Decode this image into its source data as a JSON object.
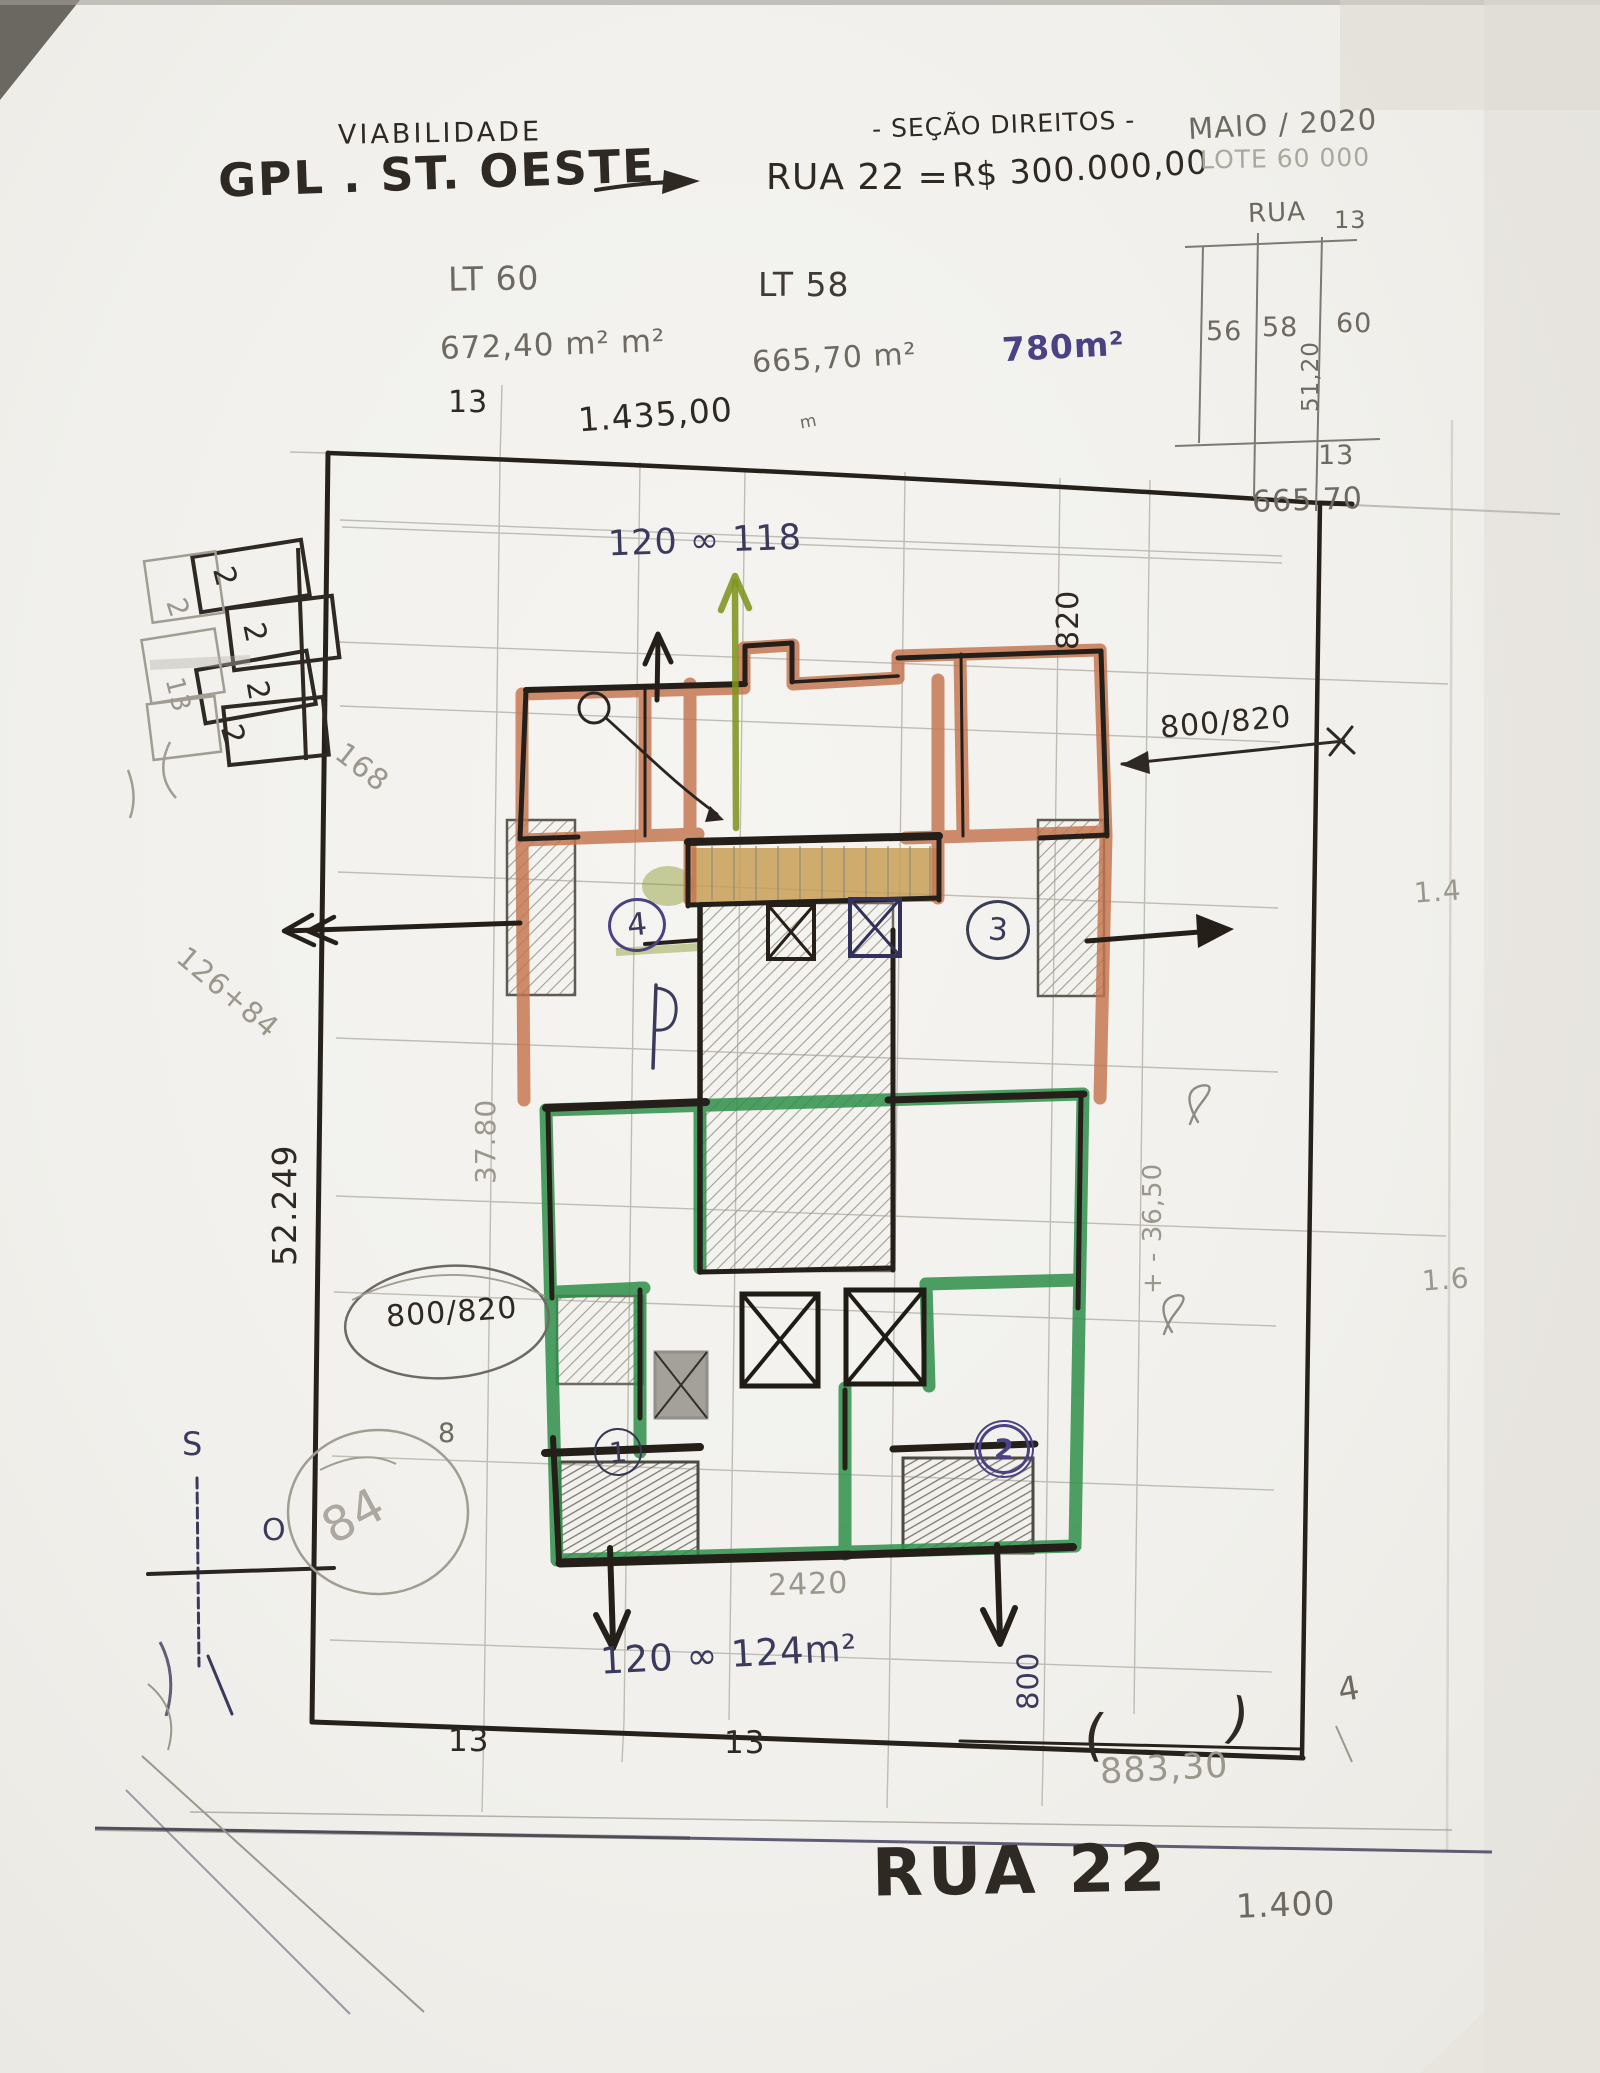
{
  "header": {
    "subtitle": "VIABILIDADE",
    "title": "GPL . ST. OESTE",
    "section_note": "- SEÇÃO DIREITOS -",
    "street": "RUA 22 =",
    "price": "R$ 300.000,00",
    "date": "MAIO / 2020",
    "lot_note": "LOTE 60 000"
  },
  "lots": {
    "lt60": {
      "label": "LT 60",
      "area": "672,40 m² m²"
    },
    "lt58": {
      "label": "LT 58",
      "area": "665,70 m²"
    },
    "proposed_area": "780m²"
  },
  "minimap": {
    "street": "RUA",
    "street_number": "13",
    "lot_56": "56",
    "lot_58": "58",
    "lot_60": "60",
    "width": "51,20",
    "front": "13",
    "depth": "665 70"
  },
  "dimensions": {
    "front_13": "13",
    "top_length": "1.435,00",
    "top_length_unit": "m",
    "units_top": "120 ∞ 118",
    "depth_820": "820",
    "right_800_820": "800/820",
    "left_52_249": "52.249",
    "note_126_84": "126+84",
    "note_168": "168",
    "width_37_80": "37.80",
    "level_36_50": "+ - 36,50",
    "circled_800_820": "800/820",
    "note_84": "84",
    "note_8": "8",
    "bottom_2420": "2420",
    "units_bottom": "120 ∞ 124m²",
    "bottom_800": "800",
    "bottom_13_left": "13",
    "bottom_13_right": "13",
    "paren_open": "(",
    "bottom_length": "883,30",
    "paren_close": ")",
    "edge_1_4": "1.4",
    "edge_1_6": "1.6",
    "edge_4": "4"
  },
  "streets": {
    "bottom": "RUA 22",
    "scale": "1.400"
  },
  "units": {
    "u1": "1",
    "u2": "2",
    "u3": "3",
    "u4": "4"
  },
  "compass": {
    "south": "S",
    "west": "O"
  },
  "doodle": {
    "n2a": "2",
    "n2b": "2",
    "n2c": "2",
    "n2d": "2",
    "p2": "2",
    "p13": "13"
  },
  "colors": {
    "paper": "#f2f1ee",
    "ink": "#2e2922",
    "pencil": "#9b978c",
    "blue_ink": "#3c3a5c",
    "purple_ink": "#4b4283",
    "orange_wall": "#c4744d",
    "green_wall": "#2f8f4a",
    "ochre_stairs": "#c59a4d"
  }
}
